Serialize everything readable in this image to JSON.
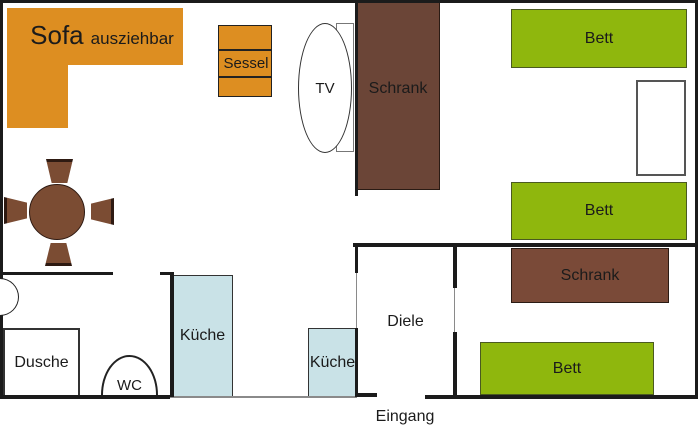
{
  "plan": {
    "title_note": "apartment floor plan",
    "colors": {
      "orange": "#DD8E21",
      "green": "#8FB70D",
      "blue": "#C9E2E7",
      "table_brown": "#7B4C33",
      "wardrobe_dark": "#6B4537",
      "wardrobe_light": "#7A4A38",
      "wall": "#1b1b1b",
      "wall_gray": "#8a8a8a"
    },
    "living_room": {
      "sofa": "Sofa",
      "sofa_note": "ausziehbar",
      "armchair": "Sessel",
      "tv": "TV",
      "wardrobe": "Schrank"
    },
    "bedroom_top": {
      "bed_1": "Bett",
      "bed_2": "Bett"
    },
    "bedroom_bottom": {
      "wardrobe": "Schrank",
      "bed": "Bett"
    },
    "kitchen": {
      "counter_large": "Küche",
      "counter_small": "Küche"
    },
    "bathroom": {
      "shower": "Dusche",
      "toilet": "WC"
    },
    "hallway": {
      "label": "Diele",
      "entrance": "Eingang"
    }
  }
}
